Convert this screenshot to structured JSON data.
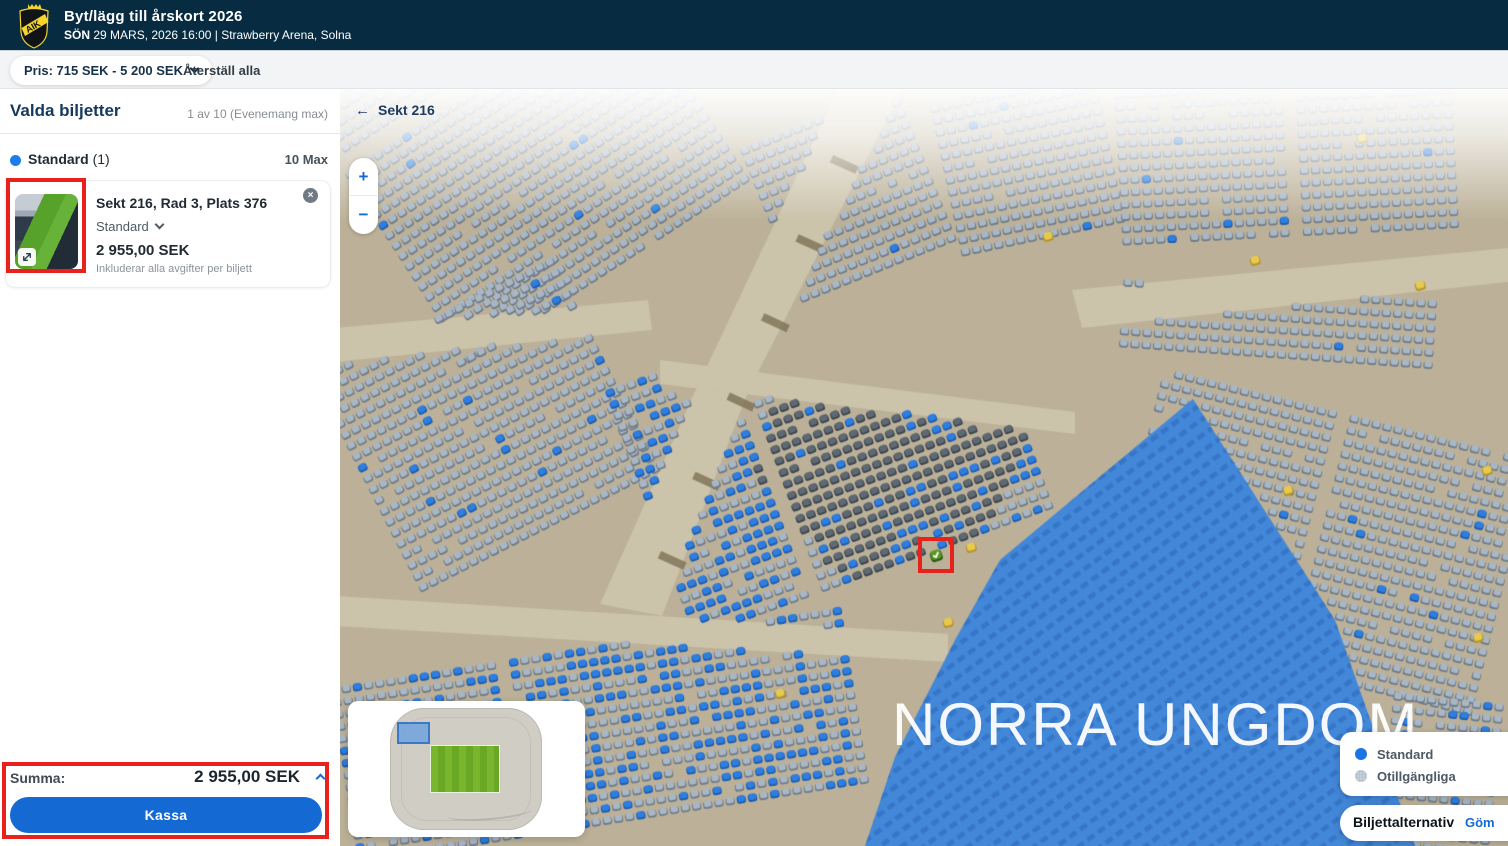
{
  "header": {
    "title": "Byt/lägg till årskort 2026",
    "date_prefix": "SÖN",
    "subtitle_rest": "29 MARS, 2026 16:00 | Strawberry Arena, Solna"
  },
  "filter_bar": {
    "price_filter": "Pris: 715 SEK - 5 200 SEK",
    "reset_label": "Återställ alla"
  },
  "sidebar": {
    "title": "Valda biljetter",
    "count_label": "1 av 10 (Evenemang max)",
    "group": {
      "name": "Standard",
      "count": "(1)",
      "max_label": "10 Max"
    },
    "ticket": {
      "title": "Sekt 216, Rad 3, Plats 376",
      "type": "Standard",
      "price": "2 955,00 SEK",
      "note": "Inkluderar alla avgifter per biljett",
      "remove_icon": "close-icon",
      "thumbnail_icon": "expand-icon"
    },
    "summary": {
      "label": "Summa:",
      "total": "2 955,00 SEK",
      "checkout_label": "Kassa"
    }
  },
  "map": {
    "back_label": "Sekt 216",
    "back_arrow": "←",
    "zoom_in": "+",
    "zoom_out": "−",
    "section_label": "NORRA UNGDOM",
    "selected_seat": {
      "section": "216",
      "row": "3",
      "seat": "376"
    },
    "legend": {
      "items": [
        {
          "label": "Standard",
          "color": "#1a74e8"
        },
        {
          "label": "Otillgängliga",
          "color": "#c7d1da"
        }
      ]
    },
    "options": {
      "label": "Biljettalternativ",
      "action_label": "Göm"
    },
    "colors": {
      "background": "#bcb198",
      "walkway": "#cbc3aa",
      "stair": "#7d7055",
      "seat": "#a9b6c4",
      "seat_shadow": "#6f7b89",
      "seat_dark": "#5e6973",
      "seat_dark_shadow": "#3a434d",
      "seat_blue": "#2e7ee2",
      "seat_blue_shadow": "#1d5cad",
      "seat_yellow": "#e8c94f",
      "seat_yellow_shadow": "#b5952d",
      "seat_selected": "#5b9727",
      "seat_selected_shadow": "#2e5b15",
      "section_overlay": "#4287d8",
      "section_overlay_rows": "#2a63b5"
    }
  },
  "colors": {
    "accent": "#1569d3",
    "standard_dot": "#1f7ce8",
    "annotation": "#e8211c",
    "header_bg": "#072b41"
  }
}
